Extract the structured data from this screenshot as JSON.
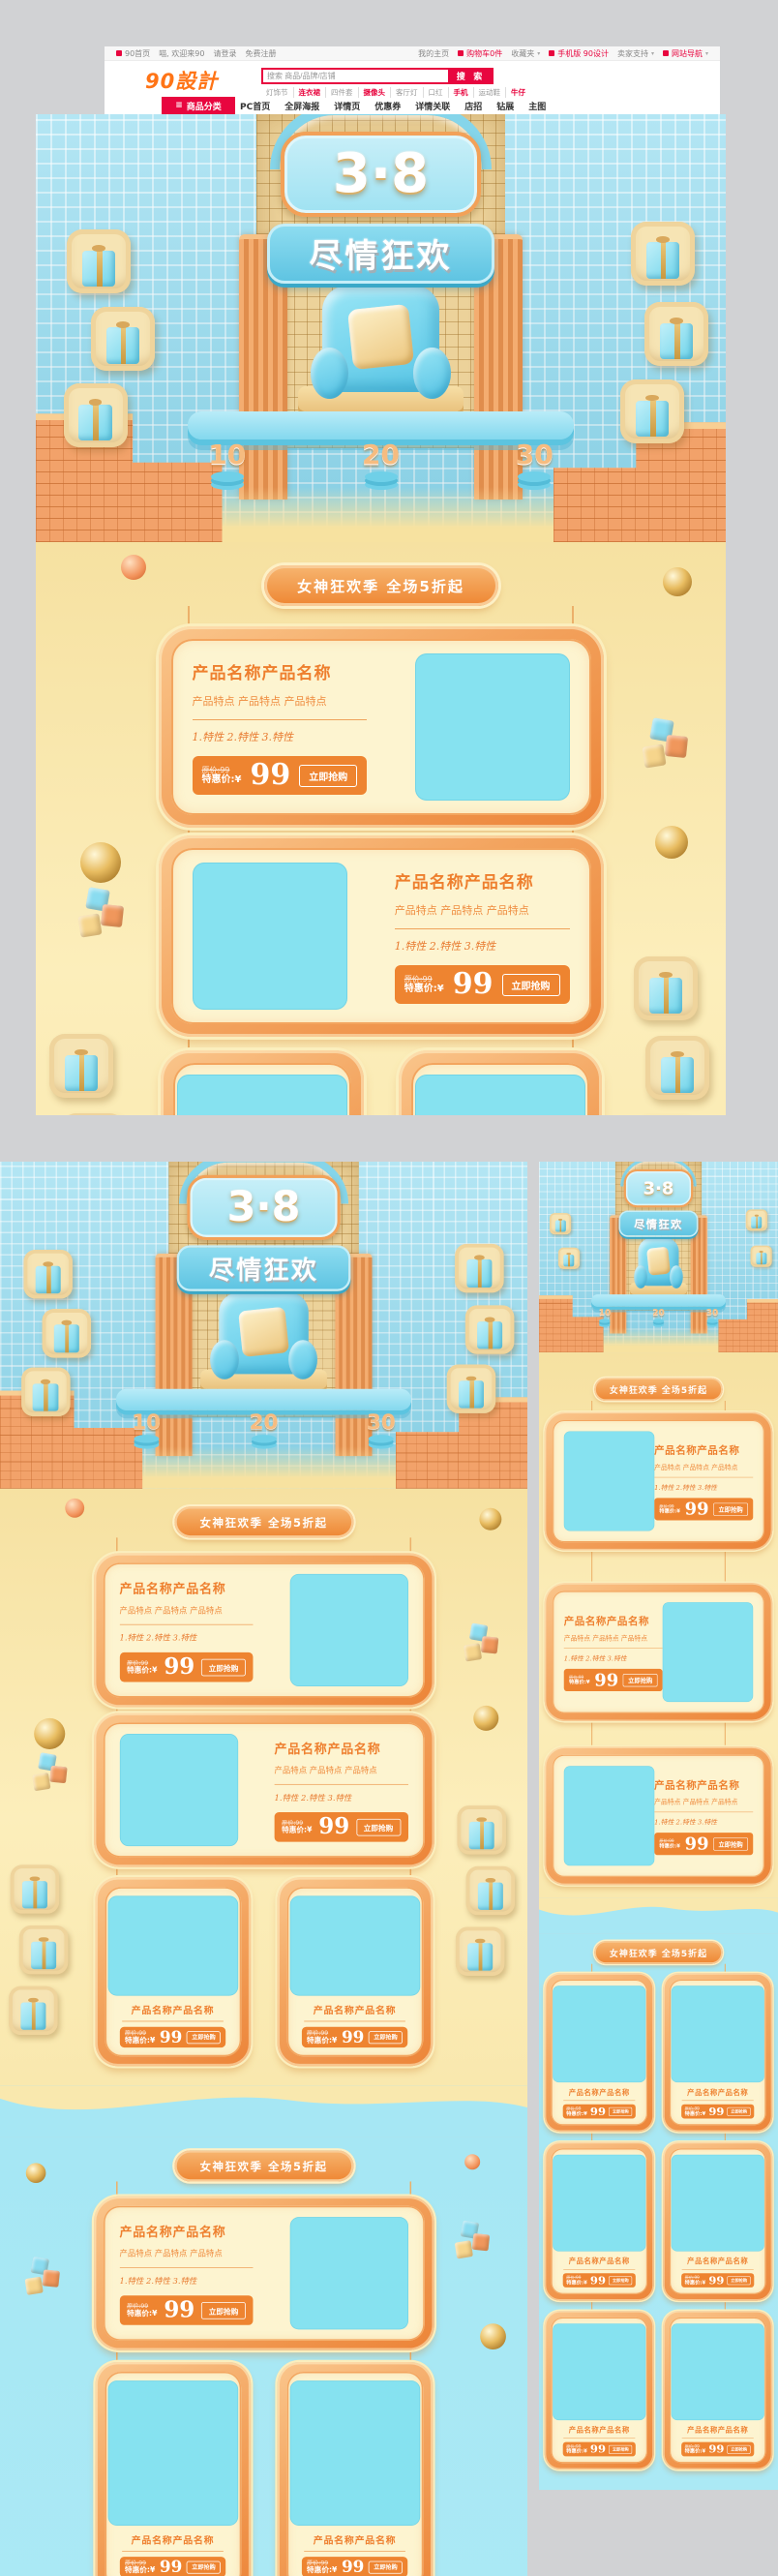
{
  "header": {
    "topbar": {
      "left": [
        {
          "label": "90首页"
        },
        {
          "label": "喵, 欢迎来90"
        },
        {
          "label": "请登录"
        },
        {
          "label": "免费注册"
        }
      ],
      "right": [
        {
          "label": "我的主页"
        },
        {
          "label": "购物车0件"
        },
        {
          "label": "收藏夹"
        },
        {
          "label": "手机版 90设计"
        },
        {
          "label": "卖家支持"
        },
        {
          "label": "网站导航"
        }
      ]
    },
    "logo": "90設計",
    "search": {
      "placeholder": "搜索 商品/品牌/店铺",
      "button": "搜 索",
      "keywords": [
        {
          "label": "灯饰节",
          "hot": false
        },
        {
          "label": "连衣裙",
          "hot": true
        },
        {
          "label": "四件套",
          "hot": false
        },
        {
          "label": "摄像头",
          "hot": true
        },
        {
          "label": "客厅灯",
          "hot": false
        },
        {
          "label": "口红",
          "hot": false
        },
        {
          "label": "手机",
          "hot": true
        },
        {
          "label": "运动鞋",
          "hot": false
        },
        {
          "label": "牛仔",
          "hot": true
        }
      ]
    },
    "nav": {
      "category": "商品分类",
      "items": [
        "PC首页",
        "全屏海报",
        "详情页",
        "优惠券",
        "详情关联",
        "店招",
        "钻展",
        "主图"
      ]
    }
  },
  "design": {
    "hero": {
      "number": "3·8",
      "slogan": "尽情狂欢",
      "podium_numbers": [
        "10",
        "20",
        "30"
      ]
    },
    "banner": "女神狂欢季 全场5折起",
    "card": {
      "title": "产品名称产品名称",
      "features": "产品特点 产品特点 产品特点",
      "specs": "1.特性  2.特性  3.特性",
      "orig_price": "原价:99",
      "price_label": "特惠价:¥",
      "price": "99",
      "buy": "立即抢购"
    },
    "colors": {
      "brand_red": "#e8063f",
      "logo_orange": "#ff7416",
      "card_orange": "#ee8430",
      "cream": "#fdf4d0",
      "image_placeholder_blue": "#86e2f0",
      "yellow_background": "#f9e7ac",
      "blue_background": "#a6e7f4",
      "gold": "#e8c070"
    }
  }
}
